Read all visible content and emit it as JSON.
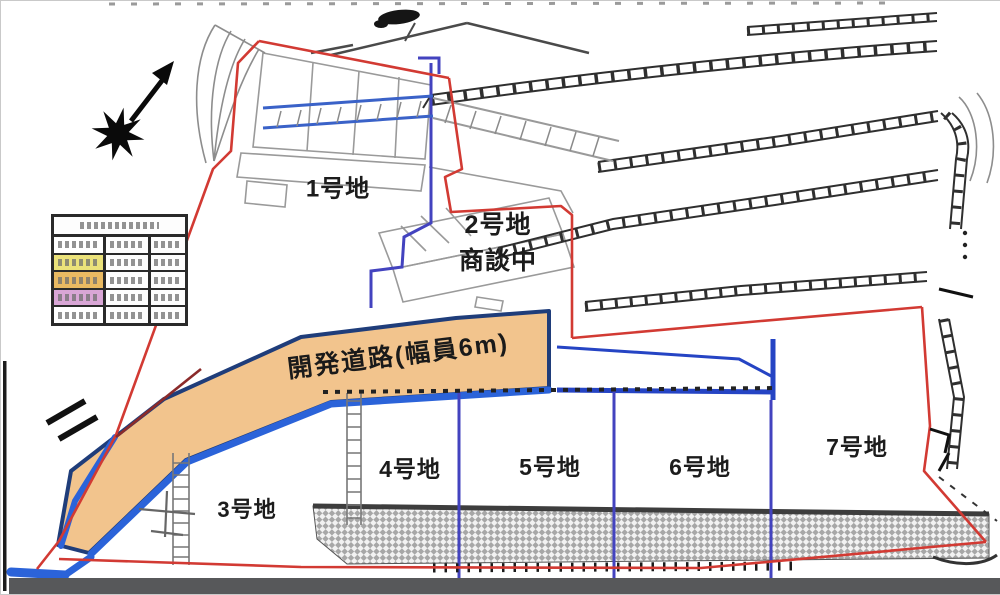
{
  "map": {
    "title": "宅地分譲区画図",
    "lots": [
      {
        "label": "1号地"
      },
      {
        "label": "2号地",
        "status": "商談中"
      },
      {
        "label": "3号地"
      },
      {
        "label": "4号地"
      },
      {
        "label": "5号地"
      },
      {
        "label": "6号地"
      },
      {
        "label": "7号地"
      }
    ],
    "road": {
      "label": "開発道路(幅員6m)",
      "fill": "#f2c48d",
      "border_color": "#1f3d7a",
      "edge_blue": "#2b63d9"
    },
    "colors": {
      "boundary_red": "#d23a33",
      "divider_blue": "#4343bf",
      "water_blue": "#2b63d9",
      "bottom_bar": "#57585a",
      "wall_hatch": "#2f2f2f"
    },
    "legend_table": {
      "columns": 3,
      "header_rows": 1,
      "rows": [
        {
          "color": "#ffffff"
        },
        {
          "color": "#ebe27a"
        },
        {
          "color": "#eaba62"
        },
        {
          "color": "#d9a6d6"
        },
        {
          "color": "#ffffff"
        }
      ]
    }
  }
}
